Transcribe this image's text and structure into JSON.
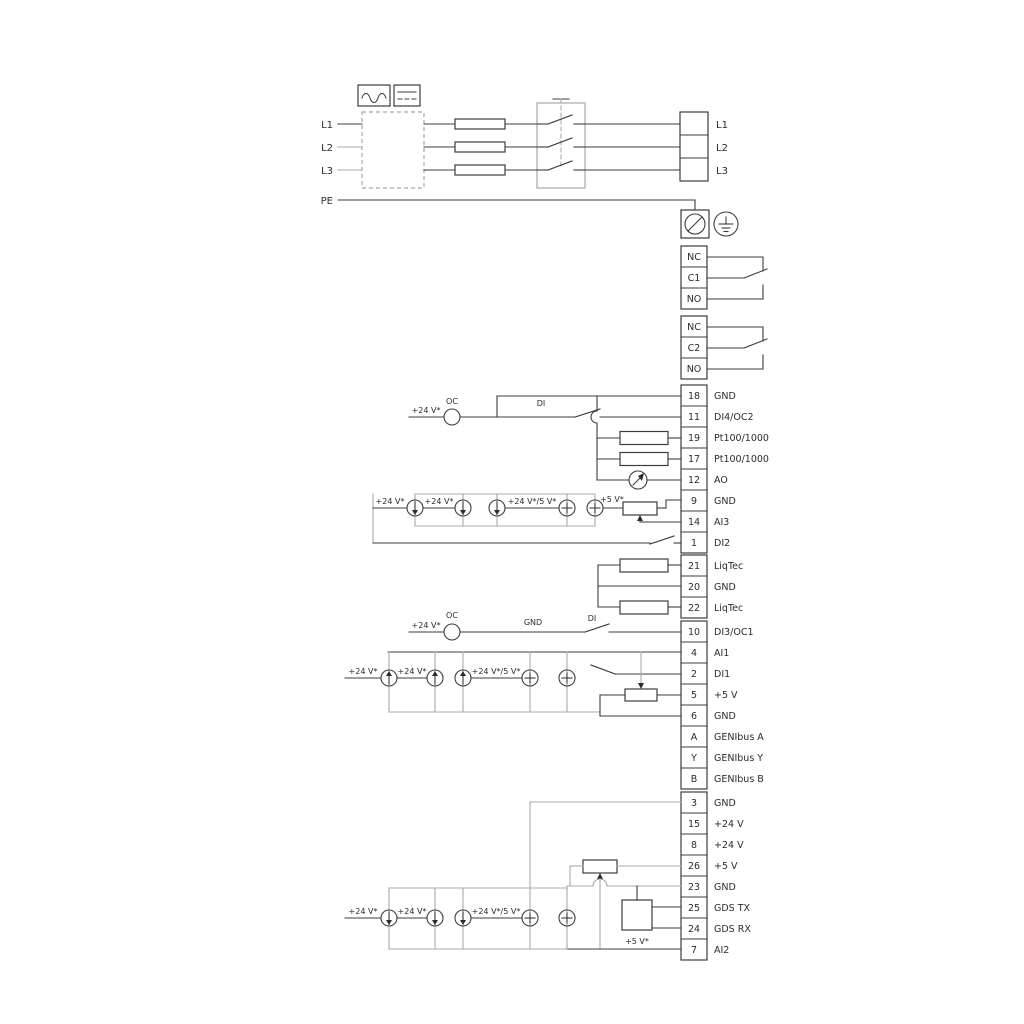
{
  "power": {
    "left": [
      "L1",
      "L2",
      "L3",
      "PE"
    ],
    "right": [
      "L1",
      "L2",
      "L3"
    ]
  },
  "relay1": [
    "NC",
    "C1",
    "NO"
  ],
  "relay2": [
    "NC",
    "C2",
    "NO"
  ],
  "labels": {
    "v24": "+24 V*",
    "v24v5": "+24 V*/5 V*",
    "v5": "+5 V*",
    "oc": "OC",
    "di": "DI",
    "gnd": "GND"
  },
  "g1": [
    {
      "n": "18",
      "t": "GND"
    },
    {
      "n": "11",
      "t": "DI4/OC2"
    },
    {
      "n": "19",
      "t": "Pt100/1000"
    },
    {
      "n": "17",
      "t": "Pt100/1000"
    },
    {
      "n": "12",
      "t": "AO"
    },
    {
      "n": "9",
      "t": "GND"
    },
    {
      "n": "14",
      "t": "AI3"
    },
    {
      "n": "1",
      "t": "DI2"
    }
  ],
  "g2": [
    {
      "n": "21",
      "t": "LiqTec"
    },
    {
      "n": "20",
      "t": "GND"
    },
    {
      "n": "22",
      "t": "LiqTec"
    }
  ],
  "g3": [
    {
      "n": "10",
      "t": "DI3/OC1"
    },
    {
      "n": "4",
      "t": "AI1"
    },
    {
      "n": "2",
      "t": "DI1"
    },
    {
      "n": "5",
      "t": "+5 V"
    },
    {
      "n": "6",
      "t": "GND"
    },
    {
      "n": "A",
      "t": "GENIbus A"
    },
    {
      "n": "Y",
      "t": "GENIbus Y"
    },
    {
      "n": "B",
      "t": "GENIbus B"
    }
  ],
  "g4": [
    {
      "n": "3",
      "t": "GND"
    },
    {
      "n": "15",
      "t": "+24 V"
    },
    {
      "n": "8",
      "t": "+24 V"
    },
    {
      "n": "26",
      "t": "+5 V"
    },
    {
      "n": "23",
      "t": "GND"
    },
    {
      "n": "25",
      "t": "GDS TX"
    },
    {
      "n": "24",
      "t": "GDS RX"
    },
    {
      "n": "7",
      "t": "AI2"
    }
  ]
}
